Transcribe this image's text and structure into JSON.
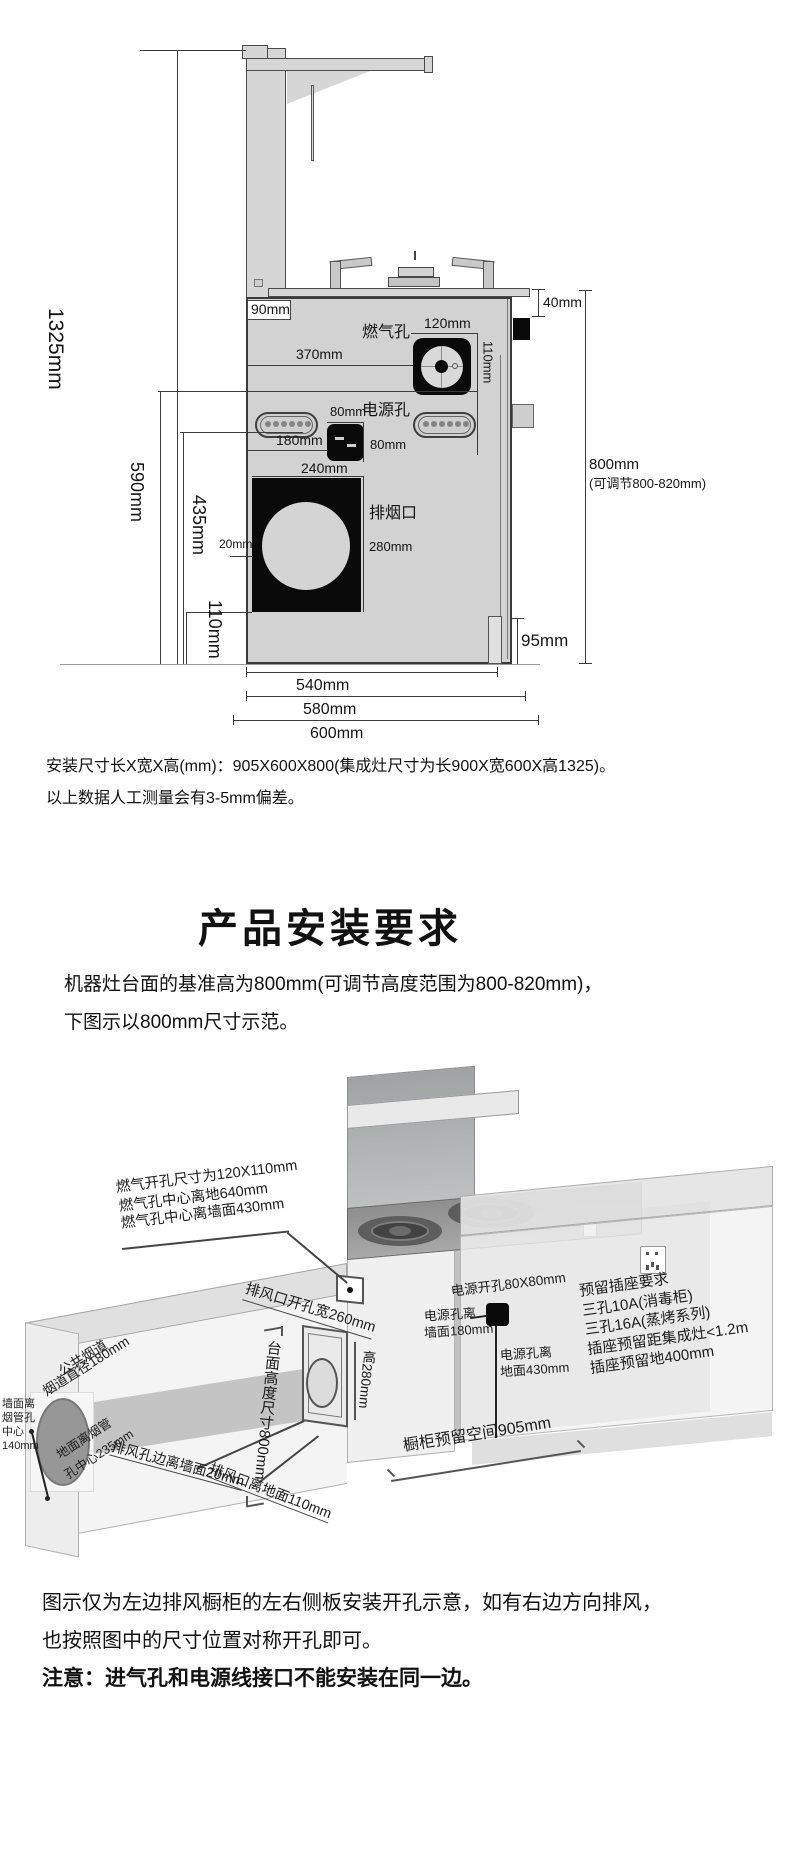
{
  "colors": {
    "diagram_fill": "#d4d4d4",
    "hole_fill": "#0a0a0a",
    "line": "#3c3c3c",
    "iso_dark_top": "#9c9c9c",
    "iso_face": "#f2f2f2"
  },
  "side_view": {
    "dim_1325": "1325mm",
    "dim_590": "590mm",
    "dim_435": "435mm",
    "dim_110_bottom": "110mm",
    "dim_90": "90mm",
    "gas_label": "燃气孔",
    "dim_120": "120mm",
    "dim_110_gas": "110mm",
    "dim_370": "370mm",
    "power_label": "电源孔",
    "dim_80_top": "80mm",
    "dim_80_right": "80mm",
    "dim_180": "180mm",
    "dim_240": "240mm",
    "smoke_label": "排烟口",
    "dim_280": "280mm",
    "dim_20": "20mm",
    "dim_40": "40mm",
    "dim_95": "95mm",
    "dim_800": "800mm",
    "dim_800_note": "(可调节800-820mm)",
    "dim_540": "540mm",
    "dim_580": "580mm",
    "dim_600": "600mm"
  },
  "install_note": {
    "line1": "安装尺寸长X宽X高(mm)：905X600X800(集成灶尺寸为长900X宽600X高1325)。",
    "line2": "以上数据人工测量会有3-5mm偏差。"
  },
  "section_title": "产品安装要求",
  "requirement": {
    "line1": "机器灶台面的基准高为800mm(可调节高度范围为800-820mm)，",
    "line2": "下图示以800mm尺寸示范。"
  },
  "iso_view": {
    "gas_line1": "燃气开孔尺寸为120X110mm",
    "gas_line2": "燃气孔中心离地640mm",
    "gas_line3": "燃气孔中心离墙面430mm",
    "vent_width": "排风口开孔宽260mm",
    "vent_height": "高280mm",
    "vent_wall": "排风孔边离墙面20mm",
    "vent_floor": "排风口离地面110mm",
    "counter_height": "台面高度尺寸800mm",
    "duct_label1": "公共烟道",
    "duct_label2": "烟道直径180mm",
    "duct_wall_line1": "墙面离",
    "duct_wall_line2": "烟管孔",
    "duct_wall_line3": "中心",
    "duct_wall_line4": "140mm",
    "duct_floor_line1": "地面离烟管",
    "duct_floor_line2": "孔中心235mm",
    "power_hole": "电源开孔80X80mm",
    "power_wall_line1": "电源孔离",
    "power_wall_line2": "墙面180mm",
    "power_floor_line1": "电源孔离",
    "power_floor_line2": "地面430mm",
    "socket_line1": "预留插座要求",
    "socket_line2": "三孔10A(消毒柜)",
    "socket_line3": "三孔16A(蒸烤系列)",
    "socket_line4": "插座预留距集成灶<1.2m",
    "socket_line5": "插座预留地400mm",
    "cabinet_space": "橱柜预留空间905mm"
  },
  "footer": {
    "line1": "图示仅为左边排风橱柜的左右侧板安装开孔示意，如有右边方向排风，",
    "line2": "也按照图中的尺寸位置对称开孔即可。",
    "note": "注意：进气孔和电源线接口不能安装在同一边。"
  }
}
